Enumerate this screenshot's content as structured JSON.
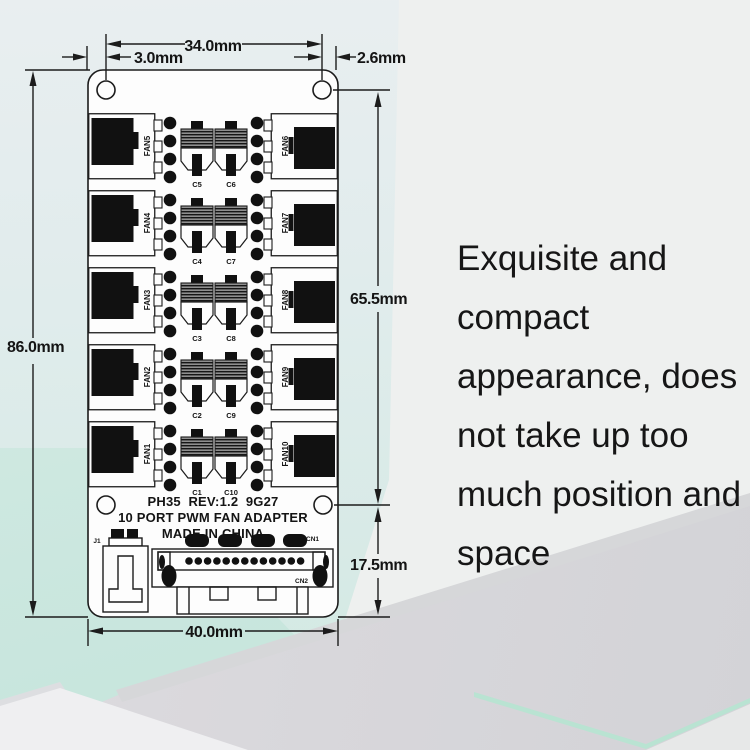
{
  "diagram": {
    "dims": {
      "top_width": "34.0mm",
      "left_hole_offset": "3.0mm",
      "right_hole_offset": "2.6mm",
      "board_height": "86.0mm",
      "hole_span": "65.5mm",
      "bottom_section": "17.5mm",
      "board_width": "40.0mm"
    },
    "silkscreen": {
      "line1": "PH35  REV:1.2  9G27",
      "line2": "10 PORT PWM FAN ADAPTER",
      "line3": "MADE IN CHINA"
    },
    "rows": [
      {
        "left_fan": "FAN5",
        "right_fan": "FAN6",
        "left_cap": "C5",
        "right_cap": "C6"
      },
      {
        "left_fan": "FAN4",
        "right_fan": "FAN7",
        "left_cap": "C4",
        "right_cap": "C7"
      },
      {
        "left_fan": "FAN3",
        "right_fan": "FAN8",
        "left_cap": "C3",
        "right_cap": "C8"
      },
      {
        "left_fan": "FAN2",
        "right_fan": "FAN9",
        "left_cap": "C2",
        "right_cap": "C9"
      },
      {
        "left_fan": "FAN1",
        "right_fan": "FAN10",
        "left_cap": "C1",
        "right_cap": "C10"
      }
    ],
    "connectors": {
      "j1": "J1",
      "cn1": "CN1",
      "cn2": "CN2"
    }
  },
  "marketing": {
    "lines": [
      "Exquisite and",
      "compact",
      "appearance, does",
      "not take up too",
      "much position and",
      "space"
    ]
  },
  "colors": {
    "accent_mint": "#b9e3d2",
    "bg_cyan": "#d7eae6",
    "line": "#1c1c1c"
  }
}
